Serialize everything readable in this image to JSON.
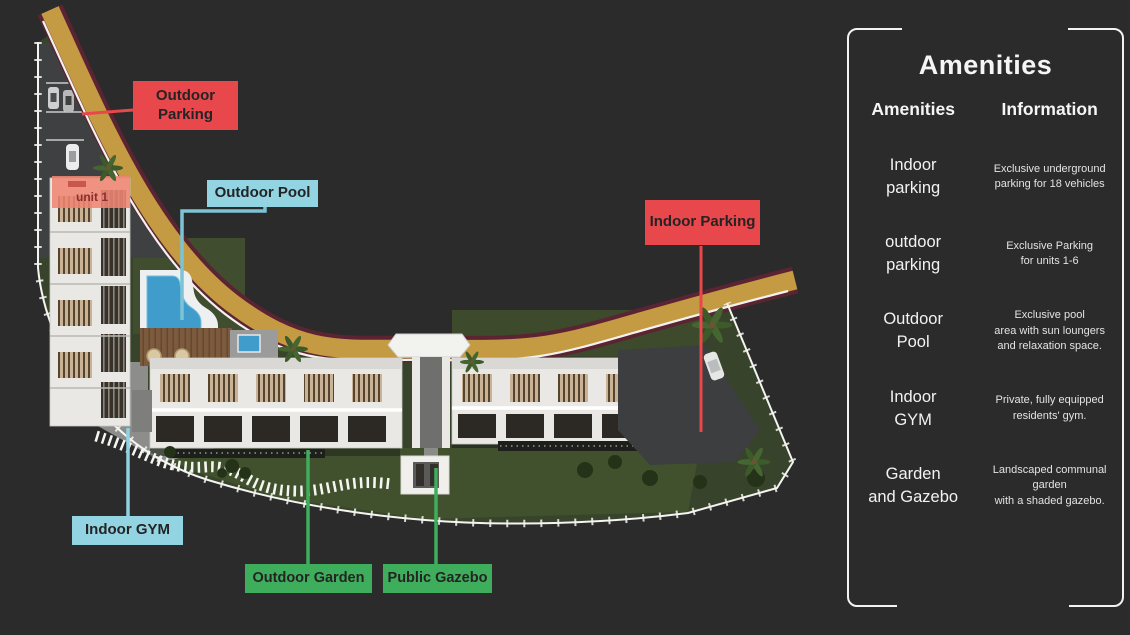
{
  "map": {
    "unit_label": "unit 1",
    "annotations": {
      "outdoor_parking": "Outdoor\nParking",
      "outdoor_pool": "Outdoor Pool",
      "indoor_parking": "Indoor Parking",
      "indoor_gym": "Indoor GYM",
      "outdoor_garden": "Outdoor Garden",
      "public_gazebo": "Public Gazebo"
    },
    "annotation_colors": {
      "parking_red": "#e8474b",
      "pool_gym_cyan": "#92d4e2",
      "garden_green": "#3fae5c"
    }
  },
  "panel": {
    "title": "Amenities",
    "columns": {
      "amenities": "Amenities",
      "information": "Information"
    },
    "rows": [
      {
        "name": "Indoor\nparking",
        "info": "Exclusive underground\nparking for 18 vehicles"
      },
      {
        "name": "outdoor\nparking",
        "info": "Exclusive Parking\nfor units 1-6"
      },
      {
        "name": "Outdoor\nPool",
        "info": "Exclusive pool\narea with sun loungers\nand relaxation space."
      },
      {
        "name": "Indoor\nGYM",
        "info": "Private, fully equipped\nresidents' gym."
      },
      {
        "name": "Garden\nand Gazebo",
        "info": "Landscaped communal\ngarden\nwith a shaded gazebo."
      }
    ]
  }
}
